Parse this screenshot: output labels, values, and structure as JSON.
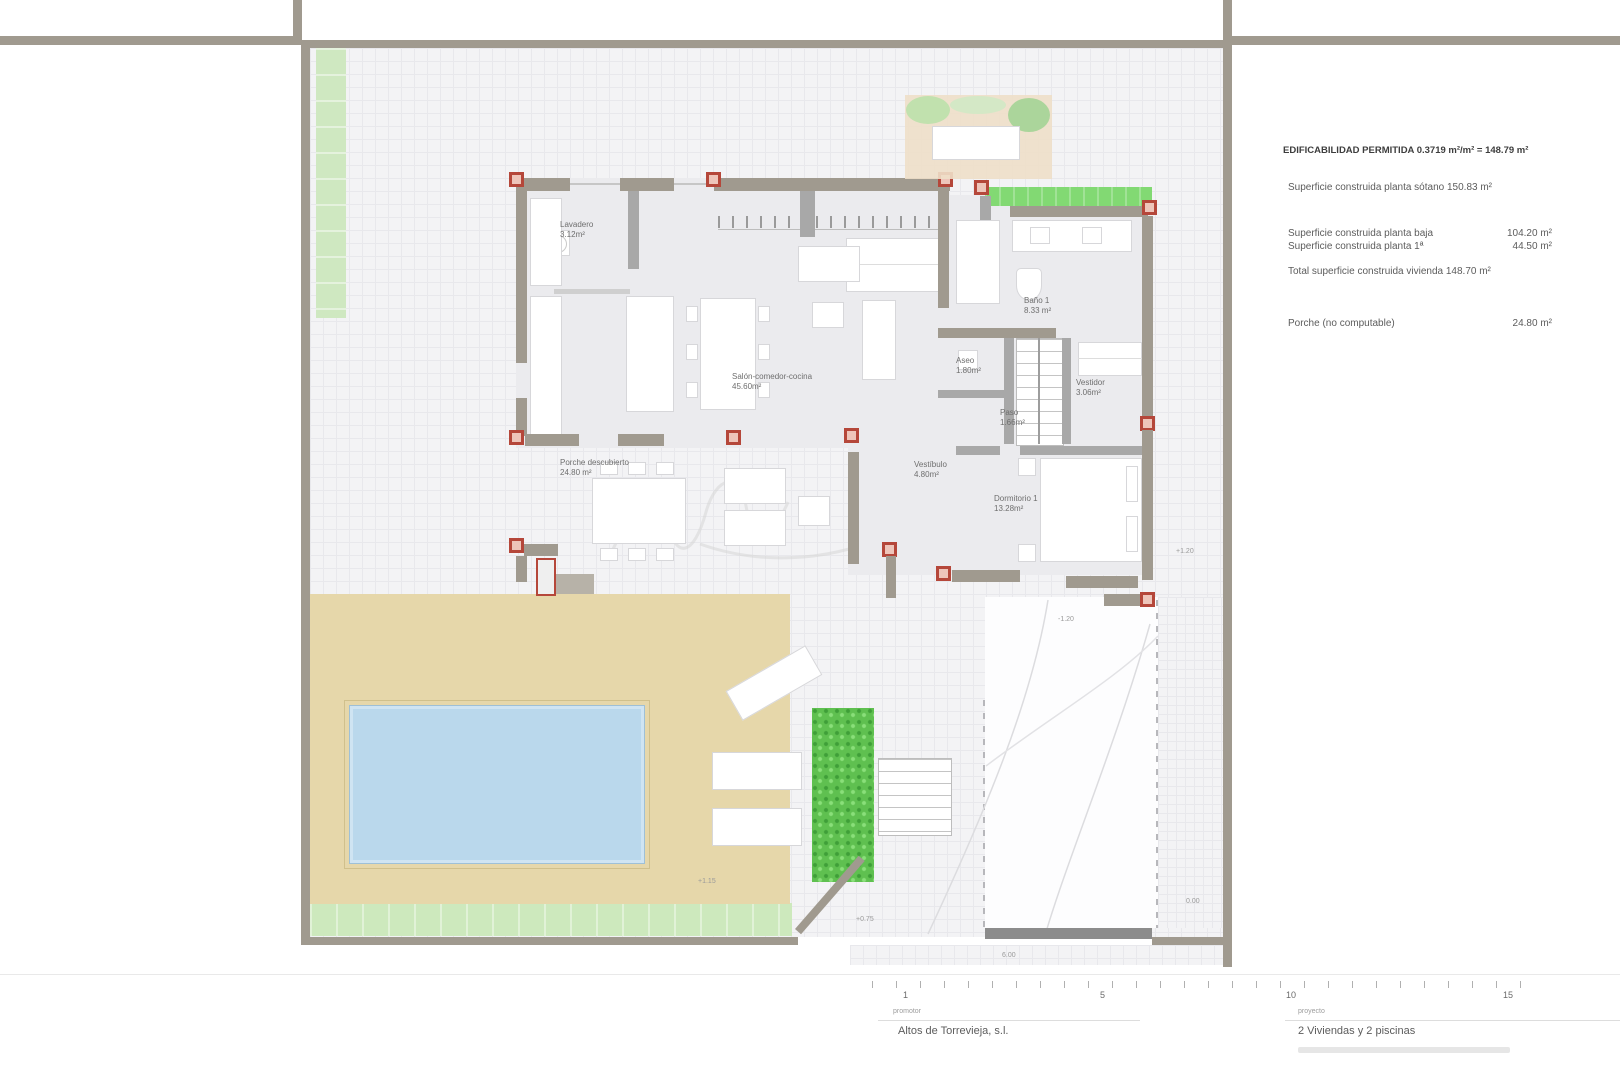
{
  "rooms": [
    {
      "name": "Lavadero",
      "area": "3.12m²"
    },
    {
      "name": "Salón-comedor-cocina",
      "area": "45.60m²"
    },
    {
      "name": "Porche descubierto",
      "area": "24.80 m²"
    },
    {
      "name": "Baño 1",
      "area": "8.33 m²"
    },
    {
      "name": "Aseo",
      "area": "1.80m²"
    },
    {
      "name": "Paso",
      "area": "1.66m²"
    },
    {
      "name": "Vestidor",
      "area": "3.06m²"
    },
    {
      "name": "Vestíbulo",
      "area": "4.80m²"
    },
    {
      "name": "Dormitorio 1",
      "area": "13.28m²"
    }
  ],
  "summary": {
    "title": "EDIFICABILIDAD PERMITIDA 0.3719 m²/m² = 148.79 m²",
    "rows": [
      {
        "label": "Superficie construida planta sótano 150.83 m²",
        "value": ""
      },
      {
        "label": "Superficie construida planta baja",
        "value": "104.20 m²"
      },
      {
        "label": "Superficie construida planta 1ª",
        "value": "44.50 m²"
      },
      {
        "label": "Total superficie construida vivienda 148.70 m²",
        "value": ""
      },
      {
        "label": "Porche (no computable)",
        "value": "24.80 m²"
      }
    ]
  },
  "annotations": {
    "levels": {
      "terrace": "+1.15",
      "step": "+0.75",
      "driveway": "-1.20",
      "house_side": "+1.20",
      "entrance": "0.00",
      "gate_width": "6.00"
    }
  },
  "scale_bar": {
    "ticks": [
      "1",
      "5",
      "10",
      "15"
    ]
  },
  "footer": {
    "promoter_label": "promotor",
    "promoter": "Altos de Torrevieja, s.l.",
    "project_label": "proyecto",
    "project": "2 Viviendas y 2 piscinas"
  },
  "colors": {
    "wall": "#a09a8f",
    "column_red": "#b5473a",
    "terrace": "#e6d7aa",
    "pool": "#bad8ec",
    "green_strip": "#cfe8c1",
    "hedge": "#5fc050",
    "planter": "#82d973"
  }
}
